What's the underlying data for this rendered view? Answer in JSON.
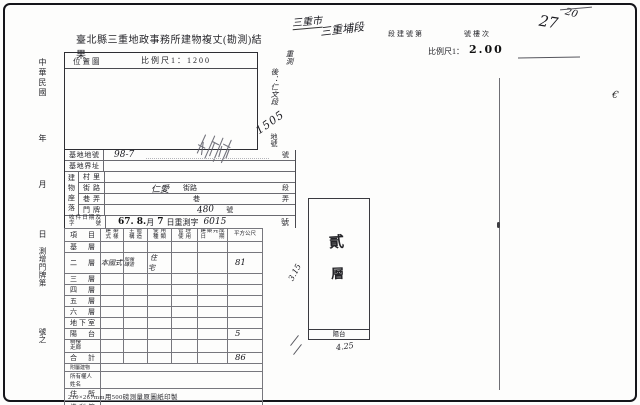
{
  "page": {
    "title": "臺北縣三重地政事務所建物複丈(勘測)結果",
    "footer": "210×267mm用500磅測量原圖紙印製"
  },
  "margin_left": {
    "era": "中華民國",
    "year": "年",
    "month": "月",
    "day": "日",
    "survey_label": "測增門牌第",
    "number_suffix": "號之"
  },
  "header_right": {
    "hand_city": "三重市",
    "hand_section": "三重埔段",
    "print_building_no": "段建號第",
    "print_floor_no": "號樓次",
    "hand_no": "27",
    "hand_no_sup": "20",
    "scale_label": "比例尺1：",
    "scale_value": "2.00"
  },
  "location_box": {
    "label": "位置圖",
    "scale": "比例尺1：1200"
  },
  "annotations": {
    "resurvey_1": "重測",
    "resurvey_2": "後：仁文段",
    "lot_no": "1505",
    "lot_label": "地號",
    "mark": "€"
  },
  "fields": {
    "lot": {
      "label": "基地地號",
      "value": "98-7",
      "suffix": "號"
    },
    "boundary": {
      "label": "基地界址"
    },
    "situs": {
      "label": "建物座落"
    },
    "village": {
      "label": "村里"
    },
    "street": {
      "label": "街路",
      "value": "仁愛",
      "print_mid": "街路",
      "suffix": "段"
    },
    "lane": {
      "label": "巷弄",
      "print_mid": "巷",
      "suffix": "弄"
    },
    "doorplate": {
      "label": "門牌",
      "value": "480",
      "suffix": "號"
    },
    "receipt": {
      "label": "收件日期及字號",
      "stamp_a": "67. 8.",
      "print_a": "月",
      "stamp_b": "7",
      "print_b": "日重測字",
      "hand": "6015",
      "print_c": "號"
    }
  },
  "floor_table": {
    "headers": {
      "item": "項目",
      "style": "建築式樣",
      "structure": "主體構造",
      "use_type": "使用種類",
      "management": "管理使用",
      "completed": "建築完成日期",
      "area": "平方公尺"
    },
    "rows": [
      {
        "label": "基層"
      },
      {
        "label": "二層",
        "style": "本國式",
        "structure": "加強磚造",
        "use": "住宅",
        "area": "81"
      },
      {
        "label": "三層"
      },
      {
        "label": "四層"
      },
      {
        "label": "五層"
      },
      {
        "label": "六層"
      },
      {
        "label": "地下室"
      },
      {
        "label": "陽台",
        "area": "5"
      },
      {
        "label": "騎樓走廊"
      },
      {
        "label": "合計",
        "area": "86"
      },
      {
        "label": "附屬建物"
      },
      {
        "label": "所有權人姓名"
      },
      {
        "label": "住所"
      },
      {
        "label": "權利範圍",
        "value": "全部"
      }
    ]
  },
  "sketch": {
    "floor_char_1": "貳",
    "floor_char_2": "層",
    "balcony": "陽台",
    "dim_bottom": "4.25",
    "dim_left": "3.15"
  }
}
